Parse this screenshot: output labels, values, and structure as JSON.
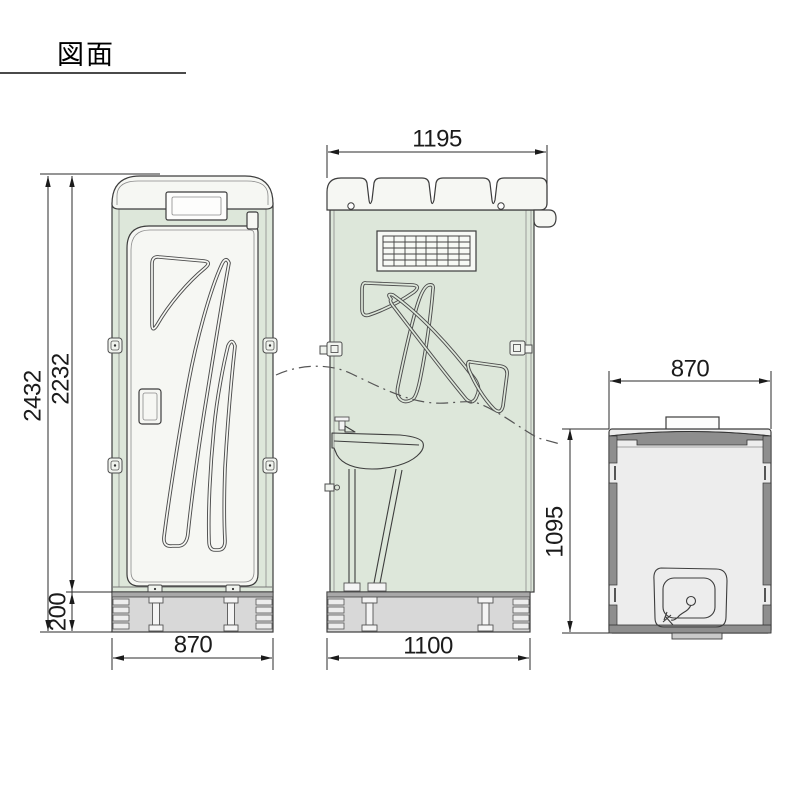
{
  "title": "図面",
  "drawing": {
    "front_view": {
      "dim_total_height": "2432",
      "dim_body_height": "2232",
      "dim_base_height": "200",
      "dim_width": "870"
    },
    "side_view": {
      "dim_roof_depth": "1195",
      "dim_base_depth": "1100"
    },
    "top_view": {
      "dim_width": "870",
      "dim_depth": "1095"
    }
  },
  "colors": {
    "body_green": "#dde7da",
    "panel_white": "#f6f7f3",
    "base_gray": "#d8d8d8",
    "base_top_gray": "#a8a8a8",
    "band_dark_gray": "#8e8e8e",
    "interior_gray": "#ededed",
    "line": "#3d3d3d"
  }
}
